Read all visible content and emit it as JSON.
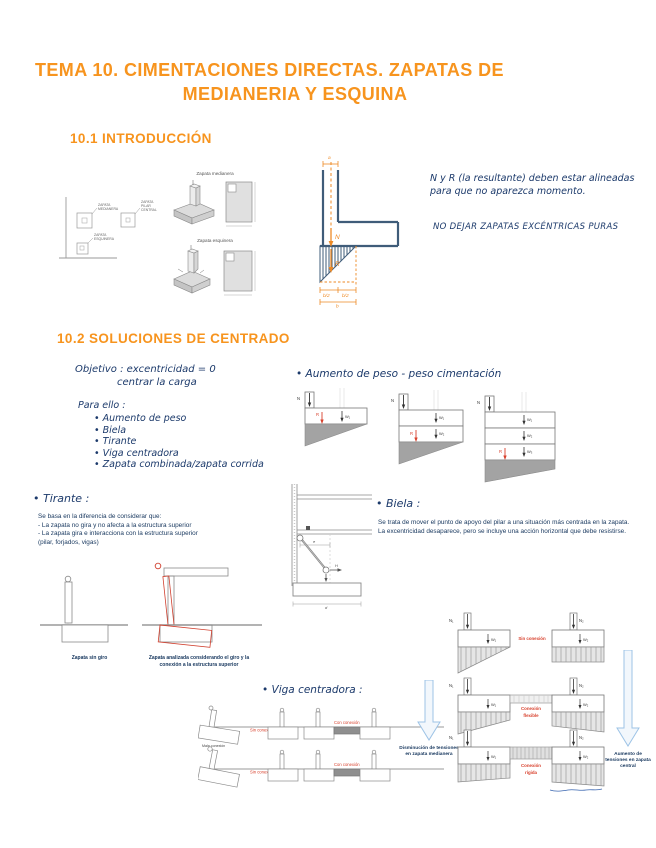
{
  "page": {
    "title_line1": "TEMA 10. CIMENTACIONES DIRECTAS. ZAPATAS DE",
    "title_line2": "MEDIANERIA Y ESQUINA",
    "section1": "10.1 INTRODUCCIÓN",
    "section2": "10.2 SOLUCIONES DE CENTRADO"
  },
  "colors": {
    "orange": "#F7941E",
    "ink_blue": "#1C3A6B",
    "typed_blue": "#17375E",
    "red": "#D8402C",
    "steel_blue": "#3F5C79"
  },
  "intro": {
    "plan": {
      "medianera1": "ZAPATA",
      "medianera2": "MEDIANERA",
      "central1": "ZAPATA",
      "central2": "PILAR",
      "central3": "CENTRAL",
      "esquinera1": "ZAPATA",
      "esquinera2": "ESQUINERA"
    },
    "fig1_caption": "Zapata medianera",
    "fig2_caption": "Zapata esquinera",
    "scheme": {
      "a": "a",
      "n": "N",
      "r": "R",
      "b1": "b/2",
      "b2": "b/2",
      "b": "b"
    },
    "note1": "N y R (la resultante) deben estar alineadas para que no aparezca momento.",
    "note2": "NO DEJAR ZAPATAS EXCÉNTRICAS PURAS"
  },
  "centrado": {
    "objective1": "Objetivo : excentricidad = 0",
    "objective2": "centrar la carga",
    "para_ello": "Para ello :",
    "methods": [
      "Aumento de peso",
      "Biela",
      "Tirante",
      "Viga centradora",
      "Zapata combinada/zapata corrida"
    ]
  },
  "aumento": {
    "heading": "• Aumento de peso - peso cimentación",
    "n": "N",
    "w1": "W₁",
    "w2": "W₂",
    "w3": "W₃",
    "r": "R"
  },
  "tirante": {
    "heading": "• Tirante :",
    "lines": [
      "Se basa en la diferencia de considerar que:",
      "- La zapata no gira y no afecta a la estructura superior",
      "- La zapata gira e interacciona con la estructura superior",
      "(pilar, forjados, vigas)"
    ]
  },
  "biela": {
    "heading": "• Biela :",
    "body": "Se trata de mover el punto de apoyo del pilar a una situación más centrada en la zapata. La excentricidad desaparece, pero se incluye una acción horizontal que debe resistirse.",
    "e": "e",
    "d": "d",
    "h": "H"
  },
  "giro": {
    "caption_sin": "Zapata sin giro",
    "caption_con": "Zapata analizada considerando el giro y la conexión a la estructura superior"
  },
  "viga": {
    "heading": "• Viga centradora :",
    "mala": "Mala conexión",
    "sin": "Sin conexión",
    "con": "Con conexión"
  },
  "conexiones": {
    "n1": "N₁",
    "n2": "N₂",
    "w1": "W₁",
    "w2": "W₂",
    "row1": "Sin conexión",
    "row2a": "Conexión",
    "row2b": "flexible",
    "row3a": "Conexión",
    "row3b": "rígida",
    "arrow_left": "Disminución de tensiones en zapata medianera",
    "arrow_right": "Aumento de tensiones en zapata central"
  }
}
